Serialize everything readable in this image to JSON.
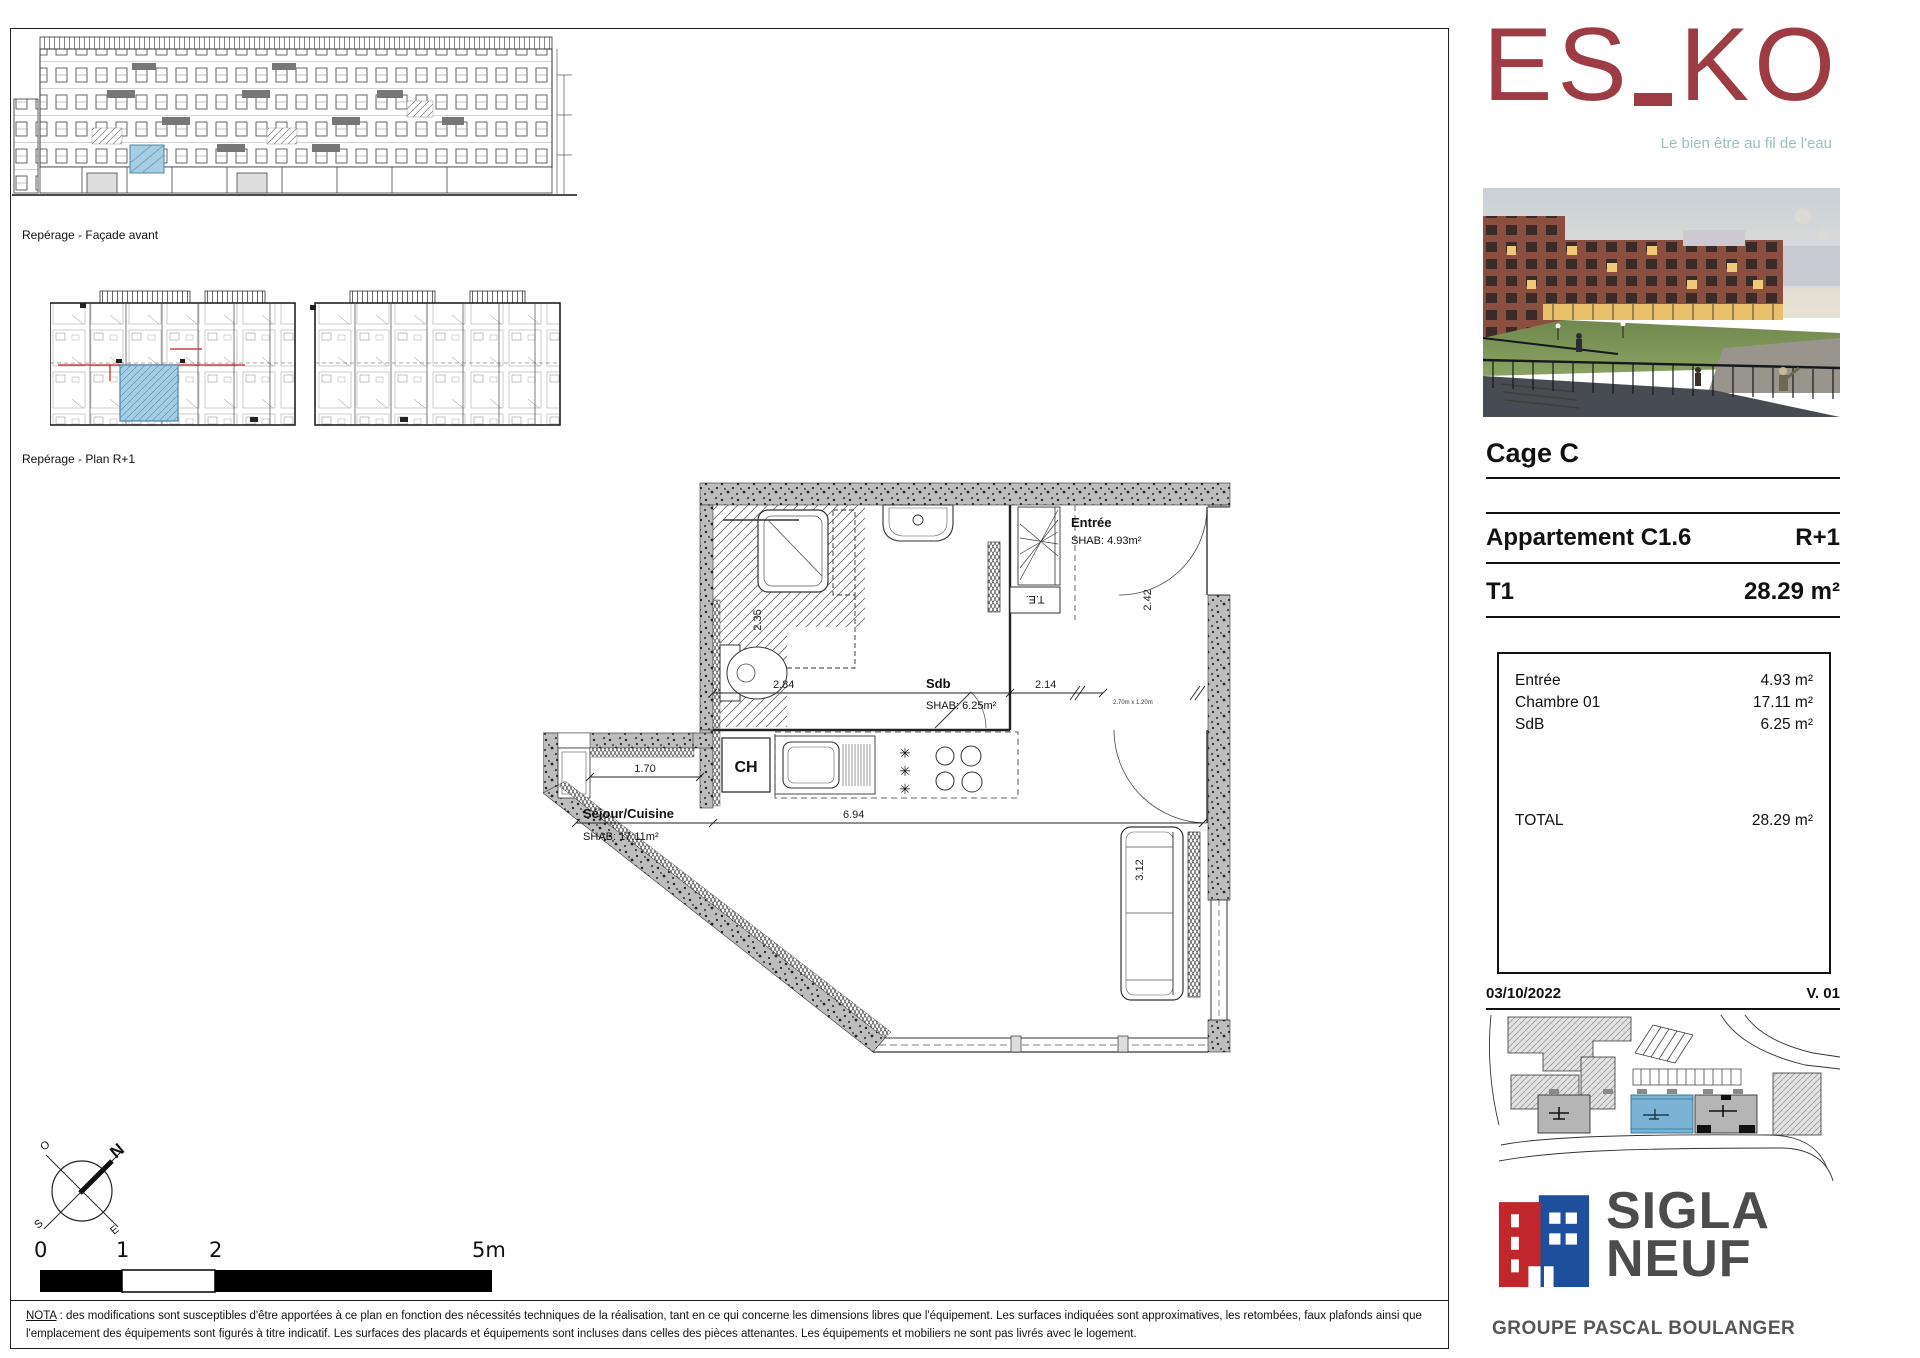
{
  "reperage": {
    "facade_label": "Repérage - Façade avant",
    "plan_label": "Repérage - Plan R+1"
  },
  "plan": {
    "entree_name": "Entrée",
    "entree_shab": "SHAB: 4.93m²",
    "sdb_name": "Sdb",
    "sdb_shab": "SHAB: 6.25m²",
    "sejour_name": "Séjour/Cuisine",
    "sejour_shab": "SHAB: 17.11m²",
    "ch_label": "CH",
    "te_label": "T.E.",
    "dim_235": "2.35",
    "dim_284": "2.84",
    "dim_214": "2.14",
    "dim_242": "2.42",
    "dim_170": "1.70",
    "dim_694": "6.94",
    "dim_312": "3.12",
    "dim_small": "2.70m x 1.20m"
  },
  "compass": {
    "n": "N",
    "o": "O",
    "s": "S",
    "e": "E"
  },
  "scalebar": {
    "t0": "0",
    "t1": "1",
    "t2": "2",
    "t5": "5m"
  },
  "nota": {
    "label": "NOTA",
    "text": " : des modifications sont susceptibles d'être apportées à ce plan en fonction des nécessités techniques de la réalisation, tant en ce qui concerne les dimensions libres que l'équipement. Les surfaces indiquées sont approximatives, les retombées, faux plafonds ainsi que l'emplacement des équipements sont figurés à titre indicatif. Les surfaces des placards et équipements sont incluses dans celles des pièces attenantes. Les équipements et mobiliers ne sont pas livrés avec le logement."
  },
  "sidebar": {
    "logo": {
      "part1": "ES",
      "part2": "KO",
      "tagline": "Le bien être au fil de l'eau"
    },
    "cage": "Cage C",
    "apartment": {
      "label": "Appartement C1.6",
      "floor": "R+1",
      "type": "T1",
      "area": "28.29 m²"
    },
    "areas": {
      "rows": [
        {
          "label": "Entrée",
          "value": "4.93 m²"
        },
        {
          "label": "Chambre 01",
          "value": "17.11 m²"
        },
        {
          "label": "SdB",
          "value": "6.25 m²"
        }
      ],
      "total_label": "TOTAL",
      "total_value": "28.29 m²"
    },
    "date": "03/10/2022",
    "version": "V. 01",
    "brand": {
      "line1": "SIGLA",
      "line2": "NEUF",
      "group": "GROUPE PASCAL BOULANGER"
    }
  },
  "colors": {
    "esko_red": "#9d3c44",
    "tagline_teal": "#9bbfc1",
    "sigla_red": "#c0272d",
    "sigla_blue": "#1d4f9c",
    "sigla_gray": "#4c4c4e",
    "highlight_blue": "#a7cde2"
  }
}
